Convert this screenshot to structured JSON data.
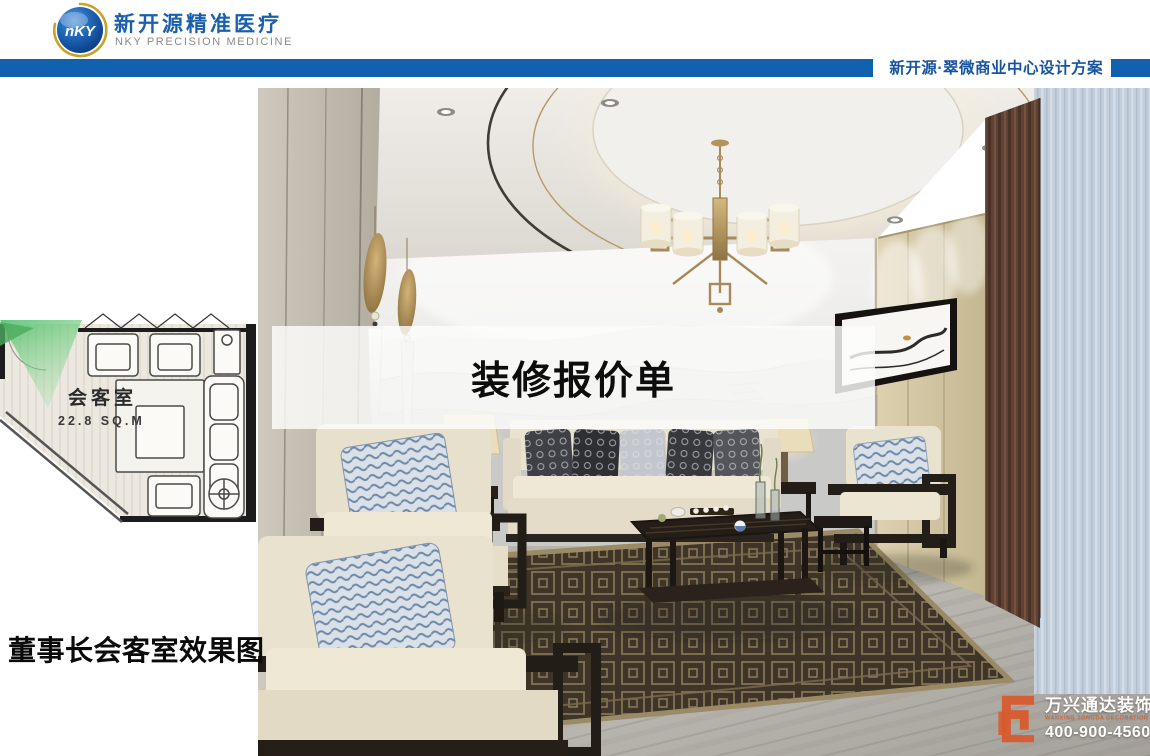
{
  "header": {
    "logo": {
      "mark": "nKY",
      "brand_cn": "新开源精准医疗",
      "brand_en": "NKY PRECISION MEDICINE"
    },
    "project_bar": {
      "title": "新开源·翠微商业中心设计方案"
    }
  },
  "floor_plan": {
    "room_name": "会客室",
    "room_area": "22.8 SQ.M"
  },
  "overlay": {
    "title": "装修报价单"
  },
  "caption": "董事长会客室效果图",
  "watermark": {
    "company_cn": "万兴通达装饰",
    "company_en": "WANXING TONGDA DECORATION",
    "phone": "400-900-4560"
  },
  "colors": {
    "bar_blue": "#1261ae",
    "brand_blue": "#1a5fae",
    "bar_text_blue": "#17549f",
    "watermark_orange": "#d9582a"
  }
}
